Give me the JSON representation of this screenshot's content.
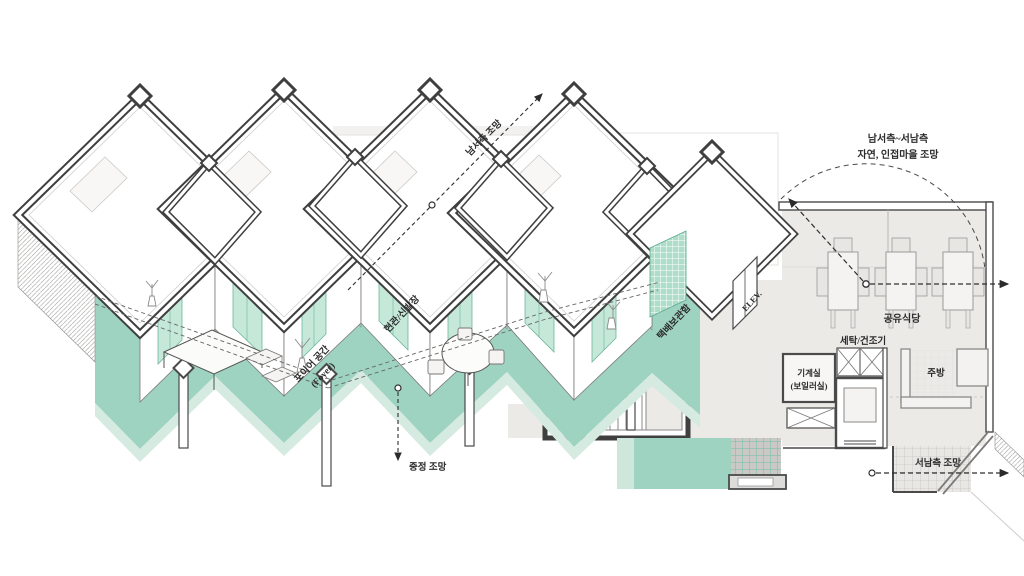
{
  "labels": {
    "view_sw": "남서측 조망",
    "view_range_1": "남서측~서남측",
    "view_range_2": "자연, 인접마을 조망",
    "view_courtyard": "중정 조망",
    "view_ssw": "서남측 조망",
    "foyer_1": "포이어 공간",
    "foyer_2": "(Foyer)",
    "entrance_shoe": "현관/신발장",
    "parcel_box": "택배보관함",
    "elevator": "ELEV.",
    "shared_dining": "공유식당",
    "laundry_dryer": "세탁/건조기",
    "machine_room_1": "기계실",
    "machine_room_2": "(보일러실)",
    "kitchen": "주방"
  },
  "colors": {
    "teal_floor": "#9ed3c2",
    "teal_light": "#d5eae1",
    "mint_glass": "#c5e8d9",
    "floor_gray": "#eceae7",
    "tile_gray": "#cbc9c6",
    "line_dark": "#3f3f3f"
  }
}
